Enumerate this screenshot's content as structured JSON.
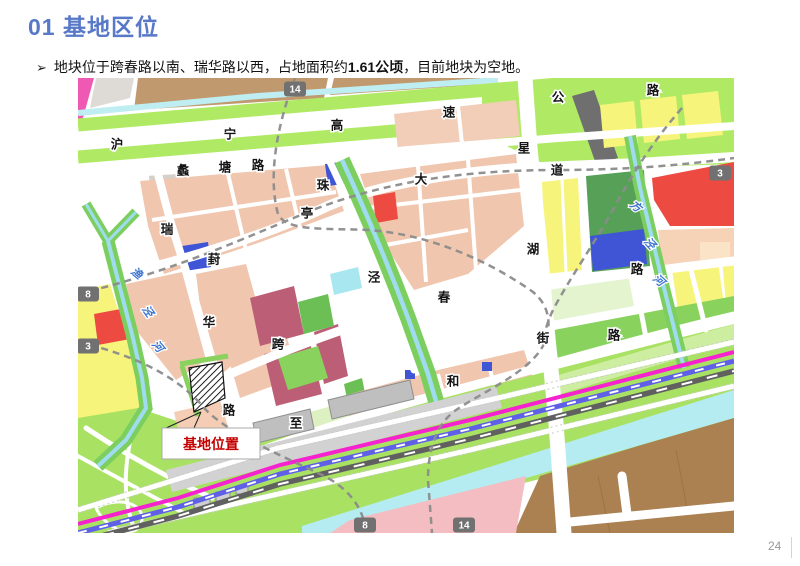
{
  "slide": {
    "title": "01 基地区位",
    "bullet": {
      "marker": "➢",
      "pre": "地块位于跨春路以南、瑞华路以西，占地面积约",
      "bold": "1.61公顷",
      "post": "，目前地块为空地。"
    },
    "page_number": "24"
  },
  "map": {
    "annotation": {
      "label": "基地位置",
      "color": "#c40000"
    },
    "roads": [
      {
        "name": "沪宁高速公路",
        "chars": [
          {
            "t": "沪",
            "x": 39,
            "y": 66
          },
          {
            "t": "宁",
            "x": 152,
            "y": 56
          },
          {
            "t": "高",
            "x": 259,
            "y": 47
          },
          {
            "t": "速",
            "x": 371,
            "y": 34
          },
          {
            "t": "公",
            "x": 480,
            "y": 19
          },
          {
            "t": "路",
            "x": 575,
            "y": 12
          }
        ]
      },
      {
        "name": "蠡塘路",
        "chars": [
          {
            "t": "蠡",
            "x": 105,
            "y": 92
          },
          {
            "t": "塘",
            "x": 147,
            "y": 89
          },
          {
            "t": "路",
            "x": 180,
            "y": 87
          }
        ]
      },
      {
        "name": "葑亭大道",
        "chars": [
          {
            "t": "葑",
            "x": 136,
            "y": 181
          },
          {
            "t": "亭",
            "x": 229,
            "y": 135
          },
          {
            "t": "大",
            "x": 343,
            "y": 101
          },
          {
            "t": "道",
            "x": 479,
            "y": 92
          }
        ]
      },
      {
        "name": "珠泾",
        "chars": [
          {
            "t": "珠",
            "x": 245,
            "y": 107
          },
          {
            "t": "泾",
            "x": 296,
            "y": 199
          }
        ]
      },
      {
        "name": "星湖街",
        "chars": [
          {
            "t": "星",
            "x": 446,
            "y": 70
          },
          {
            "t": "湖",
            "x": 455,
            "y": 171
          },
          {
            "t": "街",
            "x": 465,
            "y": 260
          }
        ]
      },
      {
        "name": "跨春路",
        "chars": [
          {
            "t": "跨",
            "x": 200,
            "y": 266
          },
          {
            "t": "春",
            "x": 366,
            "y": 219
          },
          {
            "t": "路",
            "x": 559,
            "y": 191
          }
        ]
      },
      {
        "name": "瑞华路",
        "chars": [
          {
            "t": "瑞",
            "x": 89,
            "y": 151
          },
          {
            "t": "华",
            "x": 131,
            "y": 244
          },
          {
            "t": "路",
            "x": 151,
            "y": 332
          }
        ]
      },
      {
        "name": "至和路",
        "chars": [
          {
            "t": "至",
            "x": 218,
            "y": 345
          },
          {
            "t": "和",
            "x": 375,
            "y": 303
          },
          {
            "t": "路",
            "x": 536,
            "y": 257
          }
        ]
      }
    ],
    "rivers": [
      {
        "name": "渔泾河",
        "chars": [
          {
            "t": "渔",
            "x": 59,
            "y": 195,
            "rot": 40
          },
          {
            "t": "泾",
            "x": 70,
            "y": 233,
            "rot": 55
          },
          {
            "t": "河",
            "x": 80,
            "y": 268,
            "rot": 50
          }
        ]
      },
      {
        "name": "方泾河",
        "chars": [
          {
            "t": "方",
            "x": 558,
            "y": 128,
            "rot": 40
          },
          {
            "t": "泾",
            "x": 572,
            "y": 165,
            "rot": 48
          },
          {
            "t": "河",
            "x": 581,
            "y": 202,
            "rot": 42
          }
        ]
      }
    ],
    "badges": [
      {
        "t": "14",
        "x": 217,
        "y": 11
      },
      {
        "t": "8",
        "x": 10,
        "y": 216
      },
      {
        "t": "3",
        "x": 10,
        "y": 268
      },
      {
        "t": "3",
        "x": 642,
        "y": 95
      },
      {
        "t": "8",
        "x": 287,
        "y": 447
      },
      {
        "t": "14",
        "x": 386,
        "y": 447
      }
    ]
  }
}
